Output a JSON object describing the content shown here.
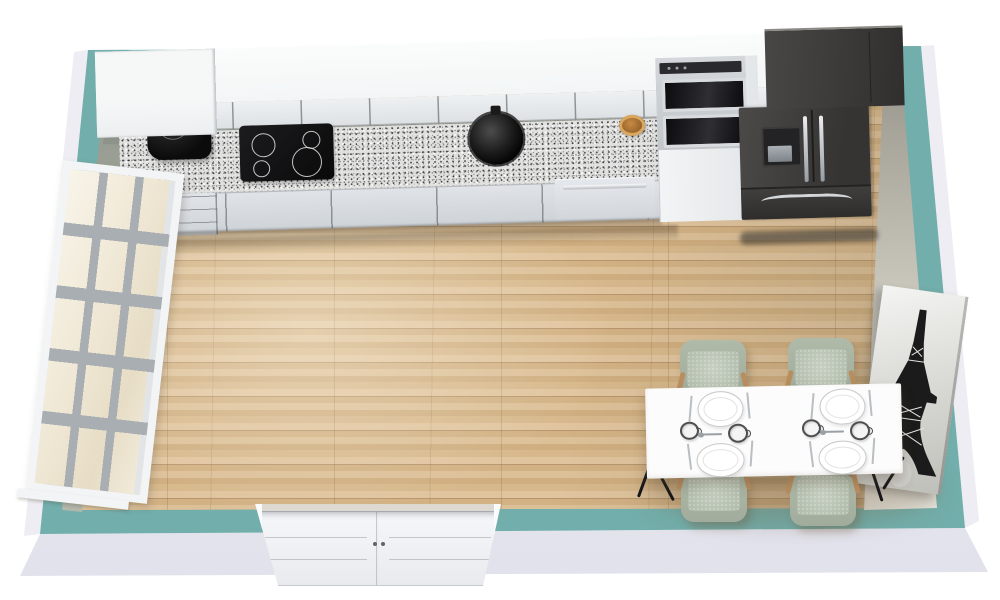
{
  "scene": {
    "title": "Kitchen 3D Floor Plan",
    "room_type": "Kitchen with dining area",
    "view": "top-down perspective render"
  },
  "palette": {
    "wall_top_edge": "#72aeab",
    "wall_exterior": "#e7e7ef",
    "floor_wood": "#d9ba8e",
    "cabinet_fronts": "#e3e6e9",
    "countertop_granite": "#dfdfdd",
    "appliance_dark": "#403e3c",
    "chair_upholstery": "#b7c1b1",
    "chair_wood": "#b98e5f",
    "table_top": "#fbfbfb",
    "art_ink": "#1b1b1b"
  },
  "objects": {
    "window": {
      "label": "Multi-pane window (3 x 5 panes)"
    },
    "upper_cabinets": {
      "label": "Upper wall cabinets"
    },
    "base_cabinets": {
      "label": "Base cabinets"
    },
    "drawer_unit": {
      "label": "Drawer unit"
    },
    "coffee_maker": {
      "label": "Coffee maker"
    },
    "cooktop": {
      "label": "4-burner cooktop",
      "burners": 4
    },
    "sink": {
      "label": "Round black sink"
    },
    "bowl": {
      "label": "Wooden bowl"
    },
    "dishwasher": {
      "label": "Dishwasher"
    },
    "wall_ovens": {
      "label": "Built-in double wall oven",
      "count": 2
    },
    "fridge": {
      "label": "French-door refrigerator with ice dispenser"
    },
    "fridge_cabinet": {
      "label": "Cabinet above refrigerator"
    },
    "dining_table": {
      "label": "Dining table with 4 place settings",
      "place_settings": 4,
      "plates": 4,
      "cups": 4
    },
    "dining_chair": {
      "label": "Upholstered dining chair",
      "count": 4
    },
    "double_door": {
      "label": "Double door",
      "leaves": 2
    },
    "wall_art": {
      "label": "Eiffel Tower canvas print"
    }
  }
}
